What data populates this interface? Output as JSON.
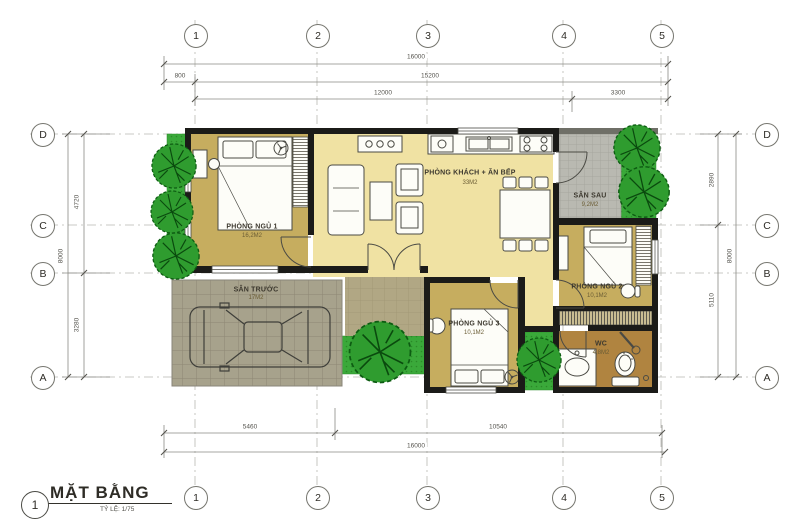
{
  "title": {
    "number": "1",
    "name": "MẶT BẰNG",
    "scale": "TỶ LỆ: 1/75"
  },
  "grid": {
    "columns": [
      "1",
      "2",
      "3",
      "4",
      "5"
    ],
    "rows": [
      "D",
      "C",
      "B",
      "A"
    ]
  },
  "dimensions": {
    "top_total": "16000",
    "top_offset": "800",
    "top_inner": "15200",
    "top_main": "12000",
    "top_right": "3300",
    "bottom_left": "5460",
    "bottom_right": "10540",
    "bottom_total": "16000",
    "left_total": "8000",
    "left_upper": "4720",
    "left_lower": "3280",
    "right_upper": "2890",
    "right_lower": "5110",
    "right_total": "8000"
  },
  "rooms": [
    {
      "name": "PHÒNG NGỦ 1",
      "area": "16,2M2"
    },
    {
      "name": "PHÒNG KHÁCH + ĂN BẾP",
      "area": "33M2"
    },
    {
      "name": "SÂN SAU",
      "area": "9,2M2"
    },
    {
      "name": "PHÒNG NGỦ 2",
      "area": "10,1M2"
    },
    {
      "name": "PHÒNG NGỦ 3",
      "area": "10,1M2"
    },
    {
      "name": "WC",
      "area": "4,8M2"
    },
    {
      "name": "SÂN TRƯỚC",
      "area": "17M2"
    }
  ],
  "colors": {
    "wall": "#1b1b18",
    "living": "#f0e2a3",
    "bedroom": "#c6ad5f",
    "wc_floor": "#b08440",
    "paving": "#a7a28c",
    "tile": "#b9b9b1",
    "porch": "#b1a784",
    "grass": "#3aa93a",
    "tree": "#2f9c2f",
    "line": "#8a8a85",
    "text": "#3c382e"
  }
}
